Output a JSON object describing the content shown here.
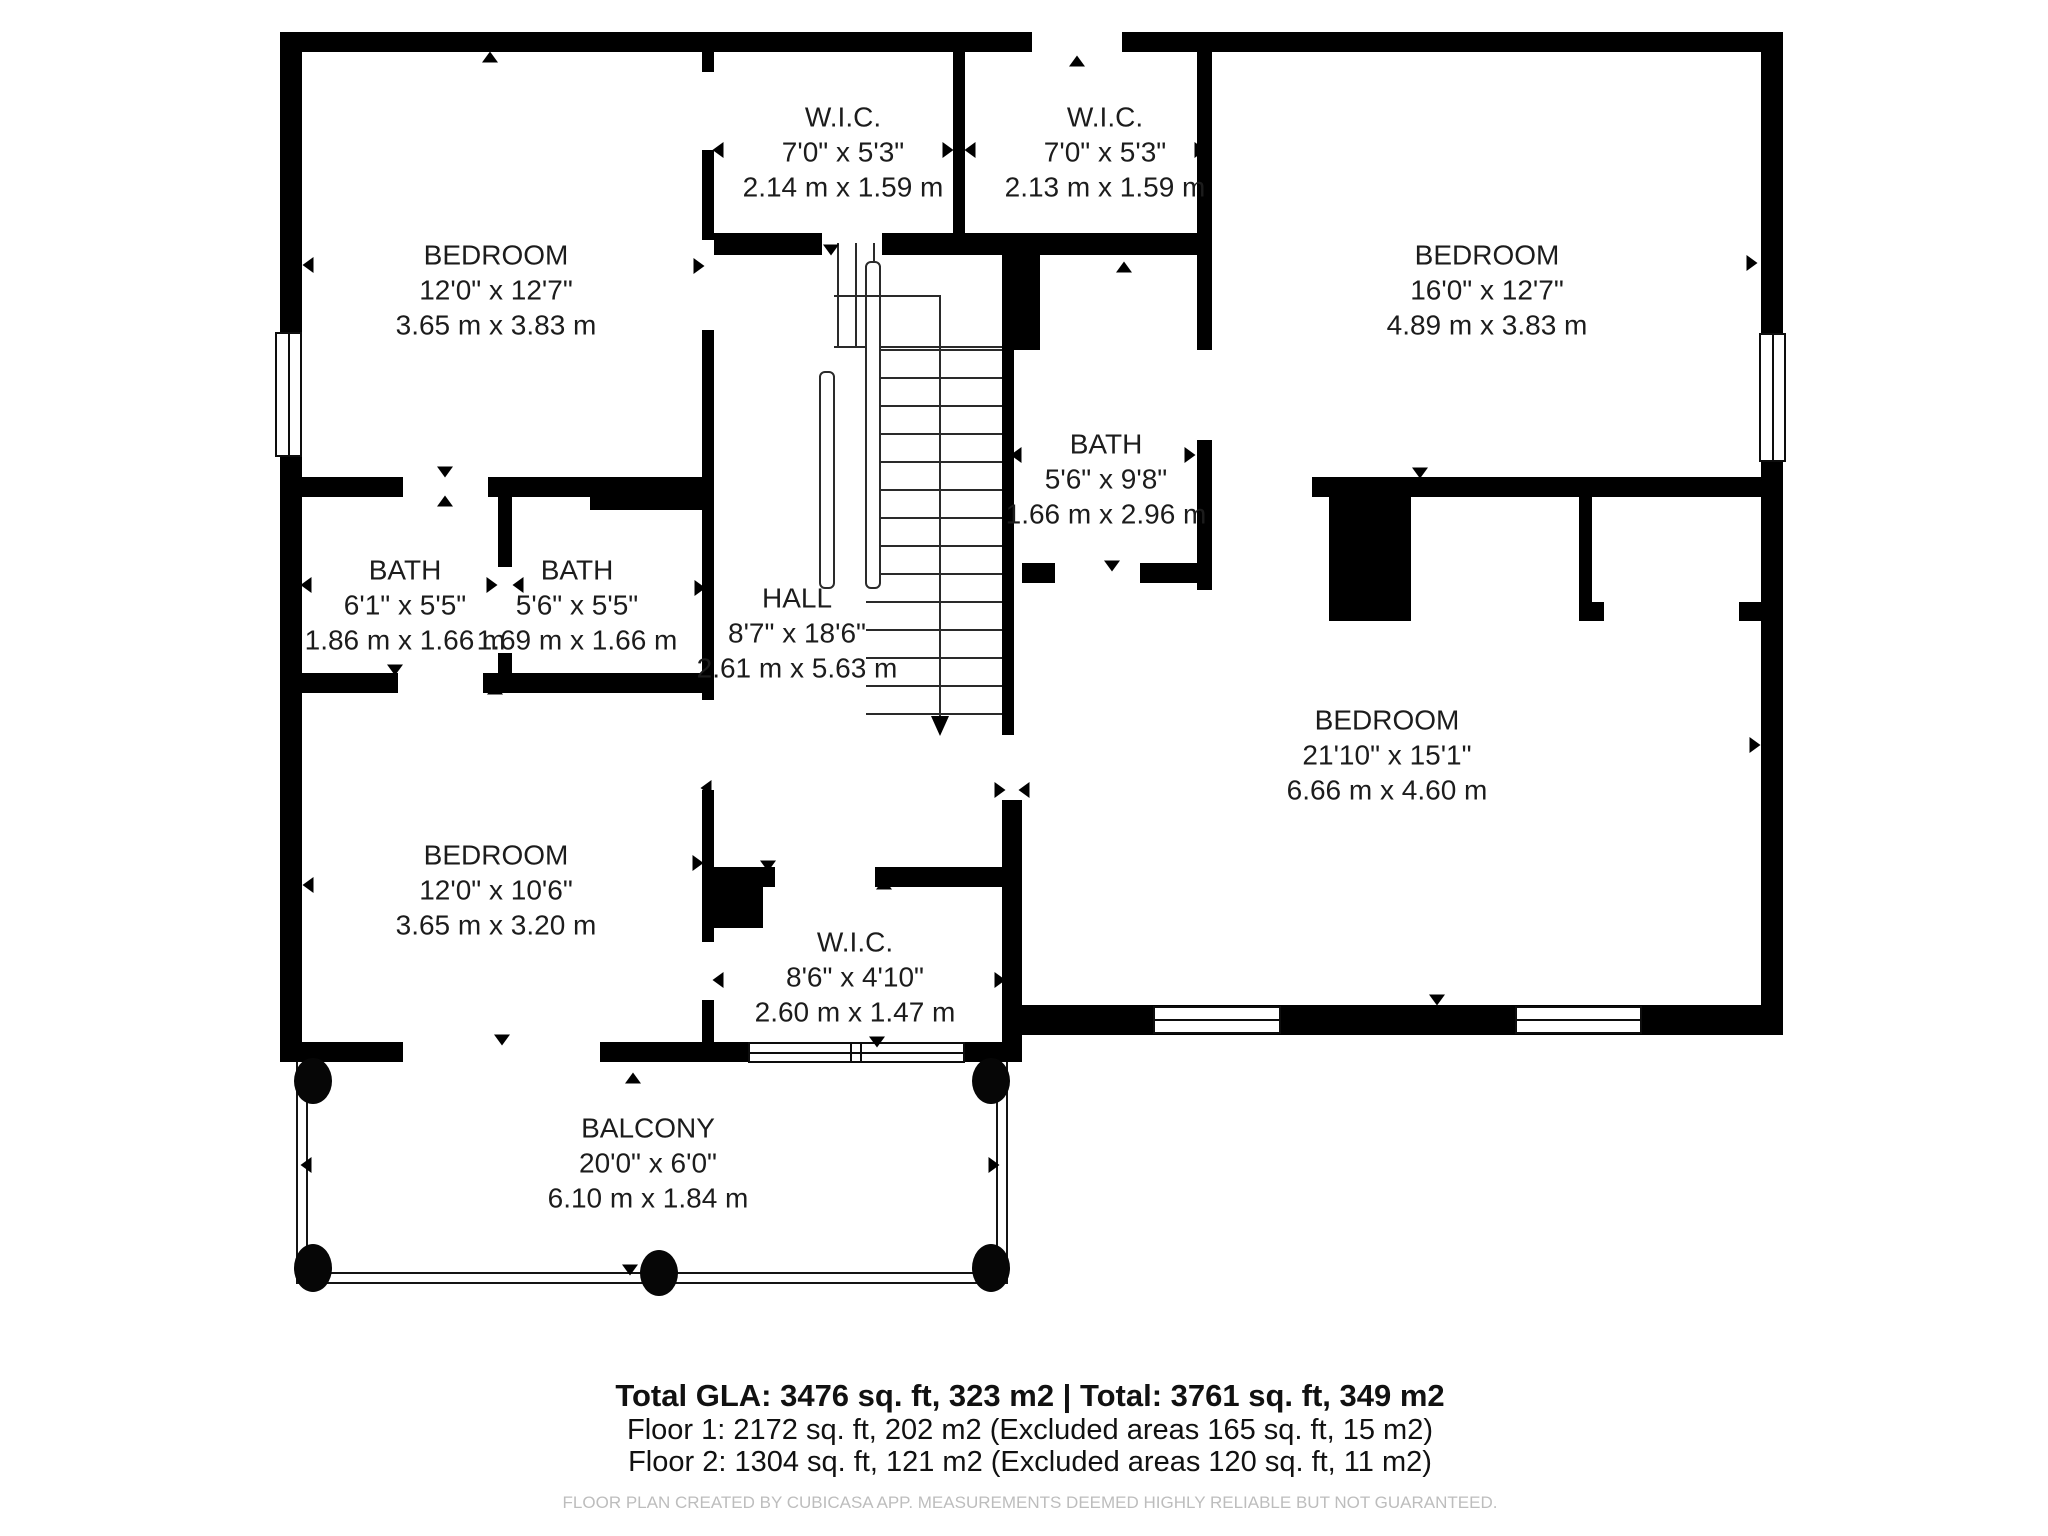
{
  "rooms": {
    "wic_top_left": {
      "name": "W.I.C.",
      "imperial": "7'0\" x 5'3\"",
      "metric": "2.14 m x 1.59 m"
    },
    "wic_top_right": {
      "name": "W.I.C.",
      "imperial": "7'0\" x 5'3\"",
      "metric": "2.13 m x 1.59 m"
    },
    "bedroom_top_left": {
      "name": "BEDROOM",
      "imperial": "12'0\" x 12'7\"",
      "metric": "3.65 m x 3.83 m"
    },
    "bedroom_top_right": {
      "name": "BEDROOM",
      "imperial": "16'0\" x 12'7\"",
      "metric": "4.89 m x 3.83 m"
    },
    "bath_left": {
      "name": "BATH",
      "imperial": "6'1\" x 5'5\"",
      "metric": "1.86 m x 1.66 m"
    },
    "bath_middle_left": {
      "name": "BATH",
      "imperial": "5'6\" x 5'5\"",
      "metric": "1.69 m x 1.66 m"
    },
    "bath_right": {
      "name": "BATH",
      "imperial": "5'6\" x 9'8\"",
      "metric": "1.66 m x 2.96 m"
    },
    "hall": {
      "name": "HALL",
      "imperial": "8'7\" x 18'6\"",
      "metric": "2.61 m x 5.63 m"
    },
    "bedroom_right": {
      "name": "BEDROOM",
      "imperial": "21'10\" x 15'1\"",
      "metric": "6.66 m x 4.60 m"
    },
    "bedroom_bottom_left": {
      "name": "BEDROOM",
      "imperial": "12'0\" x 10'6\"",
      "metric": "3.65 m x 3.20 m"
    },
    "wic_bottom": {
      "name": "W.I.C.",
      "imperial": "8'6\" x 4'10\"",
      "metric": "2.60 m x 1.47 m"
    },
    "balcony": {
      "name": "BALCONY",
      "imperial": "20'0\" x 6'0\"",
      "metric": "6.10 m x 1.84 m"
    }
  },
  "summary": {
    "total": "Total GLA: 3476 sq. ft, 323 m2 | Total: 3761 sq. ft, 349 m2",
    "floor1": "Floor 1: 2172 sq. ft, 202 m2 (Excluded areas 165 sq. ft, 15 m2)",
    "floor2": "Floor 2: 1304 sq. ft, 121 m2 (Excluded areas 120 sq. ft, 11 m2)",
    "disclaimer": "FLOOR PLAN CREATED BY CUBICASA APP. MEASUREMENTS DEEMED HIGHLY RELIABLE BUT NOT GUARANTEED."
  },
  "colors": {
    "wall": "#000000",
    "background": "#ffffff",
    "text": "#1c1c1c",
    "disclaimer": "#bdbdbd"
  }
}
